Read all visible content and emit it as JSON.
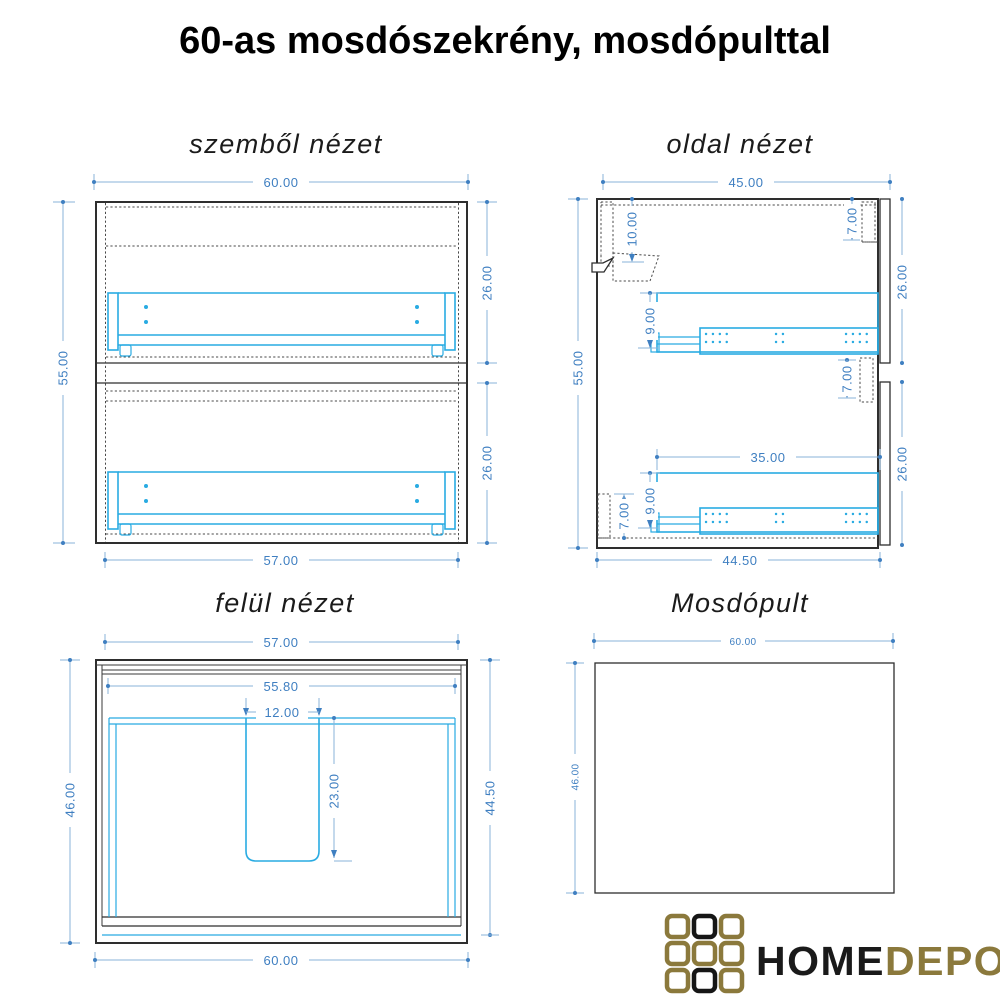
{
  "page_title": "60-as mosdószekrény, mosdópulttal",
  "views": {
    "front": {
      "title": "szemből nézet",
      "dims": {
        "overall_width": "60.00",
        "overall_height": "55.00",
        "top_drawer_front_height": "26.00",
        "bottom_drawer_front_height": "26.00",
        "carcass_width": "57.00"
      }
    },
    "side": {
      "title": "oldal nézet",
      "dims": {
        "overall_depth": "45.00",
        "overall_height": "55.00",
        "hanger_offset": "10.00",
        "top_rail_depth": "7.00",
        "top_drawer_front_height": "26.00",
        "top_drawer_box_height": "9.00",
        "mid_rail_height": "7.00",
        "slide_length": "35.00",
        "bottom_drawer_box_height": "9.00",
        "bottom_rail_height": "7.00",
        "bottom_drawer_front_height": "26.00",
        "carcass_depth": "44.50"
      }
    },
    "top": {
      "title": "felül nézet",
      "dims": {
        "carcass_width": "57.00",
        "inner_width": "55.80",
        "cutout_width": "12.00",
        "cutout_depth": "23.00",
        "overall_depth": "46.00",
        "carcass_depth": "44.50",
        "countertop_width": "60.00"
      }
    },
    "countertop": {
      "title": "Mosdópult",
      "dims": {
        "width": "60.00",
        "depth": "46.00"
      }
    }
  },
  "logo": {
    "word_primary": "HOME",
    "word_secondary": "DEPO"
  },
  "colors": {
    "hardware_cyan": "#29abe2",
    "dimension_text": "#3f7fc1",
    "dimension_line": "#8ab3d9",
    "drawing_ink": "#2e2e2e",
    "logo_gold": "#8b793c",
    "logo_black": "#161616"
  }
}
